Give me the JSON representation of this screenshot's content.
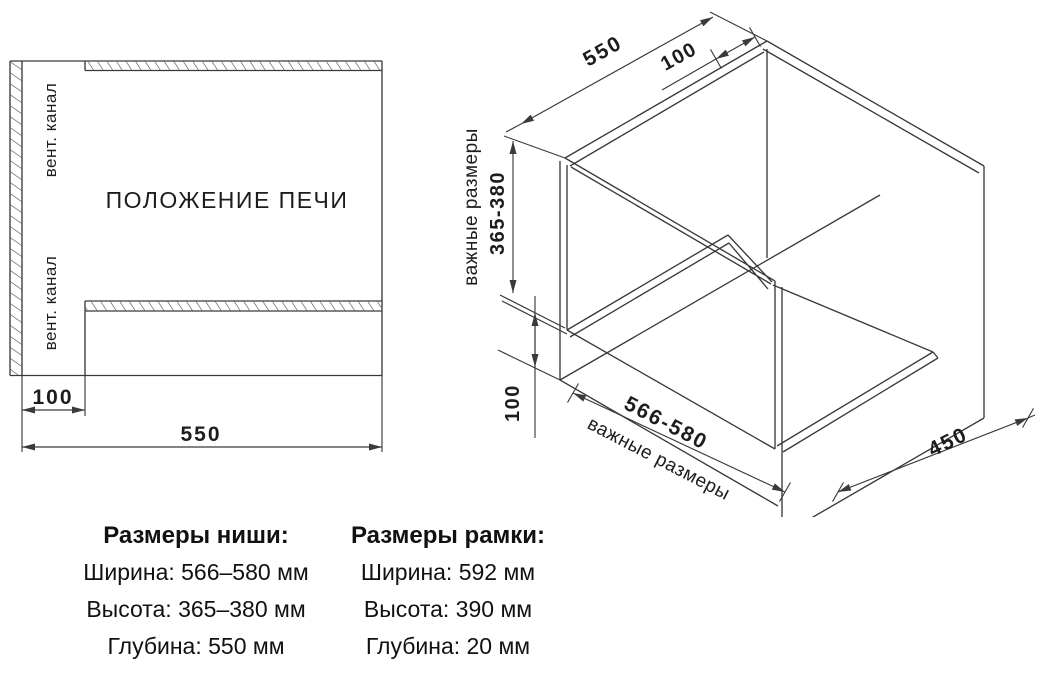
{
  "colors": {
    "line": "#3a3a3a",
    "text": "#1d1d1d",
    "background": "#ffffff"
  },
  "left_drawing": {
    "oven_position": "ПОЛОЖЕНИЕ ПЕЧИ",
    "vent_channel_top": "вент. канал",
    "vent_channel_bottom": "вент. канал",
    "dim_offset": "100",
    "dim_depth": "550"
  },
  "right_drawing": {
    "dim_depth": "550",
    "dim_top_gap": "100",
    "dim_height": "365-380",
    "important_dims_side": "важные размеры",
    "dim_bottom_gap": "100",
    "dim_width": "566-580",
    "important_dims_front": "важные размеры",
    "dim_shelf_depth": "450"
  },
  "specs": {
    "niche": {
      "title": "Размеры ниши:",
      "rows": [
        "Ширина: 566–580 мм",
        "Высота: 365–380 мм",
        "Глубина: 550 мм"
      ]
    },
    "frame": {
      "title": "Размеры рамки:",
      "rows": [
        "Ширина: 592 мм",
        "Высота: 390 мм",
        "Глубина: 20 мм"
      ]
    }
  }
}
